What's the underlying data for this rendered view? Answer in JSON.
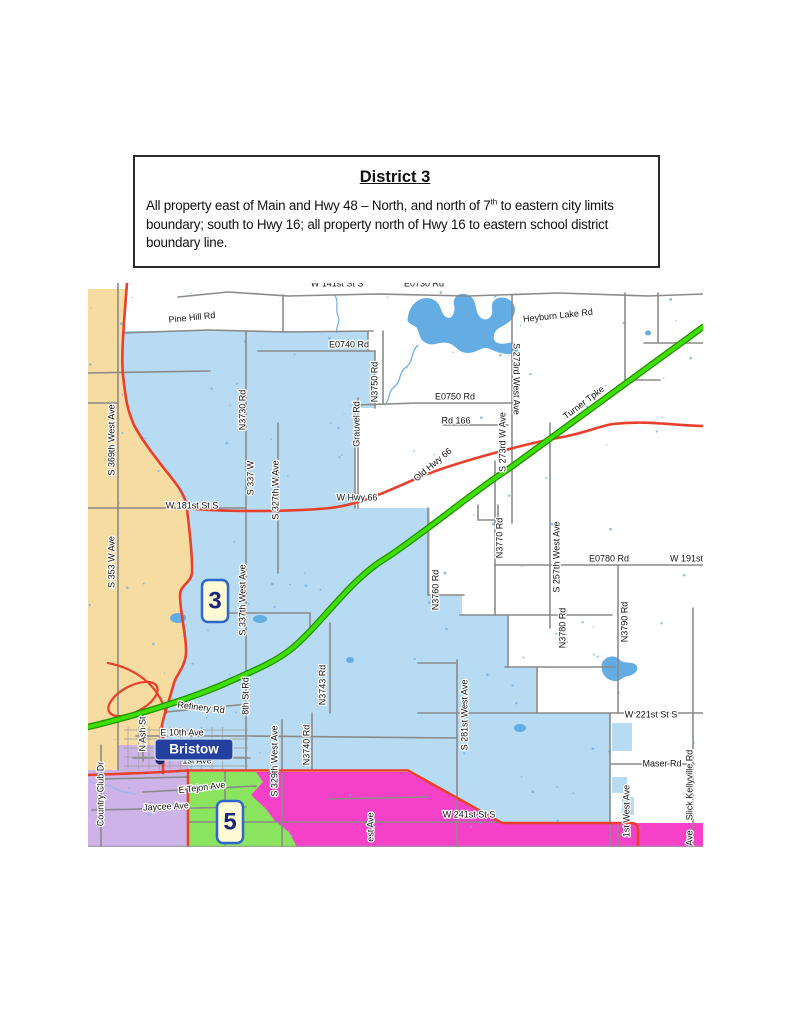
{
  "header": {
    "title": "District 3",
    "body_before_sup": "All property east of Main and Hwy 48 – North, and north of 7",
    "body_sup": "th",
    "body_after_sup": " to eastern city limits boundary; south to Hwy 16; all property north of Hwy 16 to eastern school district boundary line."
  },
  "map": {
    "town": {
      "name": "Bristow"
    },
    "badges": [
      {
        "label": "3"
      },
      {
        "label": "5"
      }
    ],
    "colors": {
      "district_blue": "#B7DBF2",
      "tan": "#F7DCA2",
      "purple": "#CDB3E8",
      "magenta": "#F441C7",
      "green": "#8BE45F",
      "water_blue": "#64ACE4",
      "highway_red": "#E8402C",
      "turnpike_green": "#3FDE00",
      "turnpike_casing": "#1F8F00",
      "road_gray": "#8A8A8A",
      "badge_fill": "#FEFBD4",
      "badge_border": "#2F66CC",
      "badge_text": "#18247E",
      "town_label_bg": "#24409E"
    },
    "labels": [
      {
        "t": "Pine Hill Rd",
        "x": 104,
        "y": 35,
        "r": -6
      },
      {
        "t": "W 141st St S",
        "x": 249,
        "y": 1
      },
      {
        "t": "E0730 Rd",
        "x": 336,
        "y": 1
      },
      {
        "t": "E0740 Rd",
        "x": 261,
        "y": 62
      },
      {
        "t": "Heyburn Lake Rd",
        "x": 470,
        "y": 33,
        "r": -6
      },
      {
        "t": "E0750 Rd",
        "x": 367,
        "y": 114
      },
      {
        "t": "Rd 166",
        "x": 368,
        "y": 138
      },
      {
        "t": "Old Hwy 66",
        "x": 345,
        "y": 182,
        "r": -40
      },
      {
        "t": "Turner Tpke",
        "x": 496,
        "y": 120,
        "r": -37
      },
      {
        "t": "W Hwy 66",
        "x": 269,
        "y": 215
      },
      {
        "t": "W 181st St S",
        "x": 104,
        "y": 223
      },
      {
        "t": "E0780 Rd",
        "x": 521,
        "y": 276
      },
      {
        "t": "W 191st St",
        "x": 604,
        "y": 276
      },
      {
        "t": "W 221st St S",
        "x": 563,
        "y": 432
      },
      {
        "t": "Maser Rd",
        "x": 574,
        "y": 481
      },
      {
        "t": "Refinery Rd",
        "x": 113,
        "y": 425,
        "r": 7
      },
      {
        "t": "E 10th Ave",
        "x": 94,
        "y": 450
      },
      {
        "t": "1st Ave",
        "x": 109,
        "y": 478
      },
      {
        "t": "E Tejon Ave",
        "x": 114,
        "y": 505,
        "r": -7
      },
      {
        "t": "Jaycee Ave",
        "x": 78,
        "y": 524,
        "r": -3
      },
      {
        "t": "W 241st St S",
        "x": 381,
        "y": 532
      },
      {
        "t": "S 369th West Ave",
        "x": 24,
        "y": 157,
        "r": -90
      },
      {
        "t": "S 353 W Ave",
        "x": 24,
        "y": 279,
        "r": -90
      },
      {
        "t": "N3730 Rd",
        "x": 155,
        "y": 127,
        "r": -90
      },
      {
        "t": "S 337 W",
        "x": 163,
        "y": 195,
        "r": -90
      },
      {
        "t": "S 327th W Ave",
        "x": 188,
        "y": 207,
        "r": -90
      },
      {
        "t": "S 337th West Ave",
        "x": 155,
        "y": 317,
        "r": -90
      },
      {
        "t": "N3750 Rd",
        "x": 287,
        "y": 99,
        "r": -90
      },
      {
        "t": "Grauvel Rd",
        "x": 269,
        "y": 141,
        "r": -90
      },
      {
        "t": "S 273rd West Ave",
        "x": 428,
        "y": 96,
        "r": 90
      },
      {
        "t": "S 273rd W Ave",
        "x": 415,
        "y": 159,
        "r": -90
      },
      {
        "t": "N3770 Rd",
        "x": 412,
        "y": 255,
        "r": -90
      },
      {
        "t": "S 257th West Ave",
        "x": 469,
        "y": 274,
        "r": -90
      },
      {
        "t": "N3760 Rd",
        "x": 348,
        "y": 307,
        "r": -90
      },
      {
        "t": "N3780 Rd",
        "x": 475,
        "y": 345,
        "r": -90
      },
      {
        "t": "N3790 Rd",
        "x": 537,
        "y": 339,
        "r": -90
      },
      {
        "t": "8th St Rd",
        "x": 158,
        "y": 413,
        "r": -90
      },
      {
        "t": "N3743 Rd",
        "x": 235,
        "y": 402,
        "r": -90
      },
      {
        "t": "N3740 Rd",
        "x": 219,
        "y": 462,
        "r": -90
      },
      {
        "t": "S 329th West Ave",
        "x": 187,
        "y": 478,
        "r": -90
      },
      {
        "t": "S 281st West Ave",
        "x": 377,
        "y": 432,
        "r": -90
      },
      {
        "t": "N Ash St",
        "x": 55,
        "y": 451,
        "r": -90
      },
      {
        "t": "Country Club Dr",
        "x": 13,
        "y": 511,
        "r": -90
      },
      {
        "t": "1st West Ave",
        "x": 539,
        "y": 528,
        "r": -90
      },
      {
        "t": "Slick Kellyville Rd",
        "x": 602,
        "y": 502,
        "r": -90
      },
      {
        "t": "est Ave",
        "x": 283,
        "y": 544,
        "r": -90
      },
      {
        "t": "Ave",
        "x": 602,
        "y": 555,
        "r": -90
      }
    ]
  }
}
